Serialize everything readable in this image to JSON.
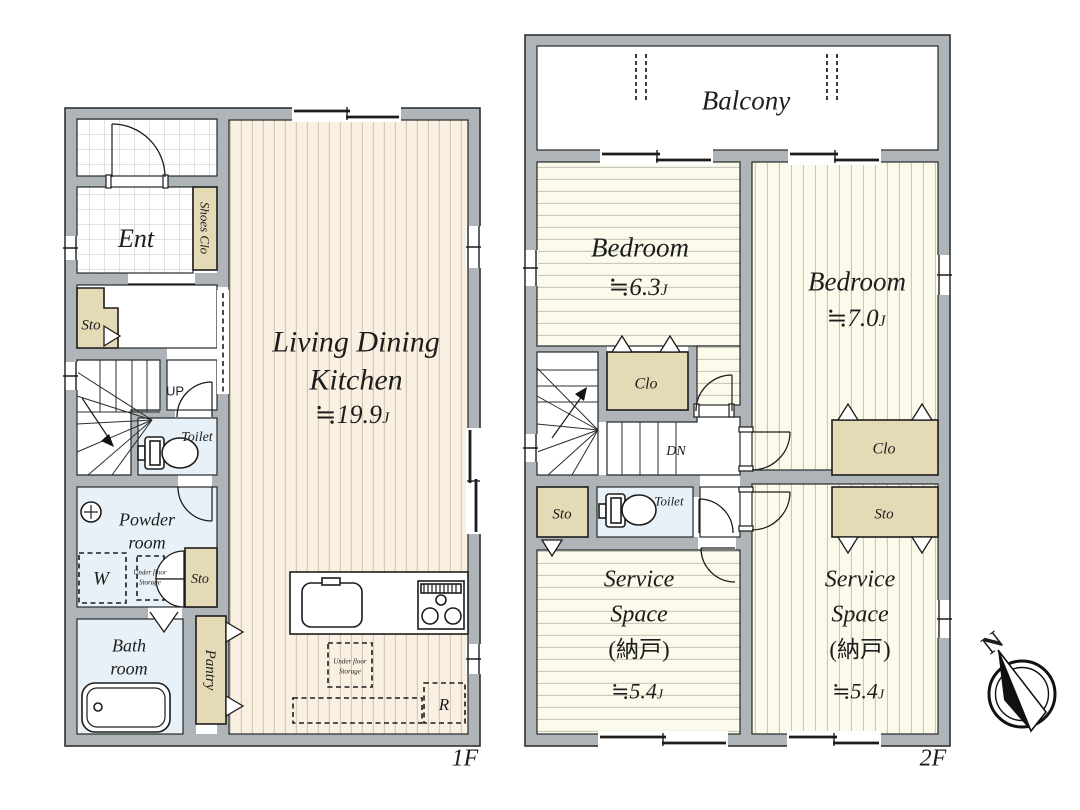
{
  "title": "Floor plan",
  "colors": {
    "wall": "#aeb4b8",
    "closet_tan": "#e4dab6",
    "water_blue": "#e8f1f7",
    "wood_floor": "#faf0e2",
    "pale_floor": "#fcfaea",
    "outline": "#2e3234"
  },
  "floor1": {
    "floor_label": "1F",
    "ent": "Ent",
    "shoes_clo": "Shoes Clo",
    "sto_entry": "Sto",
    "up": "UP",
    "toilet": "Toilet",
    "powder": {
      "line1": "Powder",
      "line2": "room"
    },
    "washer": "W",
    "ufs_powder": {
      "line1": "Under floor",
      "line2": "Storage"
    },
    "sto_powder": "Sto",
    "bath": {
      "line1": "Bath",
      "line2": "room"
    },
    "pantry": "Pantry",
    "ldk": {
      "line1": "Living Dining",
      "line2": "Kitchen",
      "size": "≒19.9",
      "unit": "J"
    },
    "ufs_kitchen": {
      "line1": "Under floor",
      "line2": "Storage"
    },
    "fridge": "R"
  },
  "floor2": {
    "floor_label": "2F",
    "balcony": "Balcony",
    "bedroom_a": {
      "name": "Bedroom",
      "size": "≒6.3",
      "unit": "J"
    },
    "bedroom_b": {
      "name": "Bedroom",
      "size": "≒7.0",
      "unit": "J"
    },
    "clo_mid": "Clo",
    "clo_right": "Clo",
    "sto_left": "Sto",
    "sto_right": "Sto",
    "dn": "DN",
    "toilet": "Toilet",
    "service_a": {
      "line1": "Service",
      "line2": "Space",
      "line3": "(納戸)",
      "size": "≒5.4",
      "unit": "J"
    },
    "service_b": {
      "line1": "Service",
      "line2": "Space",
      "line3": "(納戸)",
      "size": "≒5.4",
      "unit": "J"
    }
  },
  "compass": {
    "north": "N"
  }
}
